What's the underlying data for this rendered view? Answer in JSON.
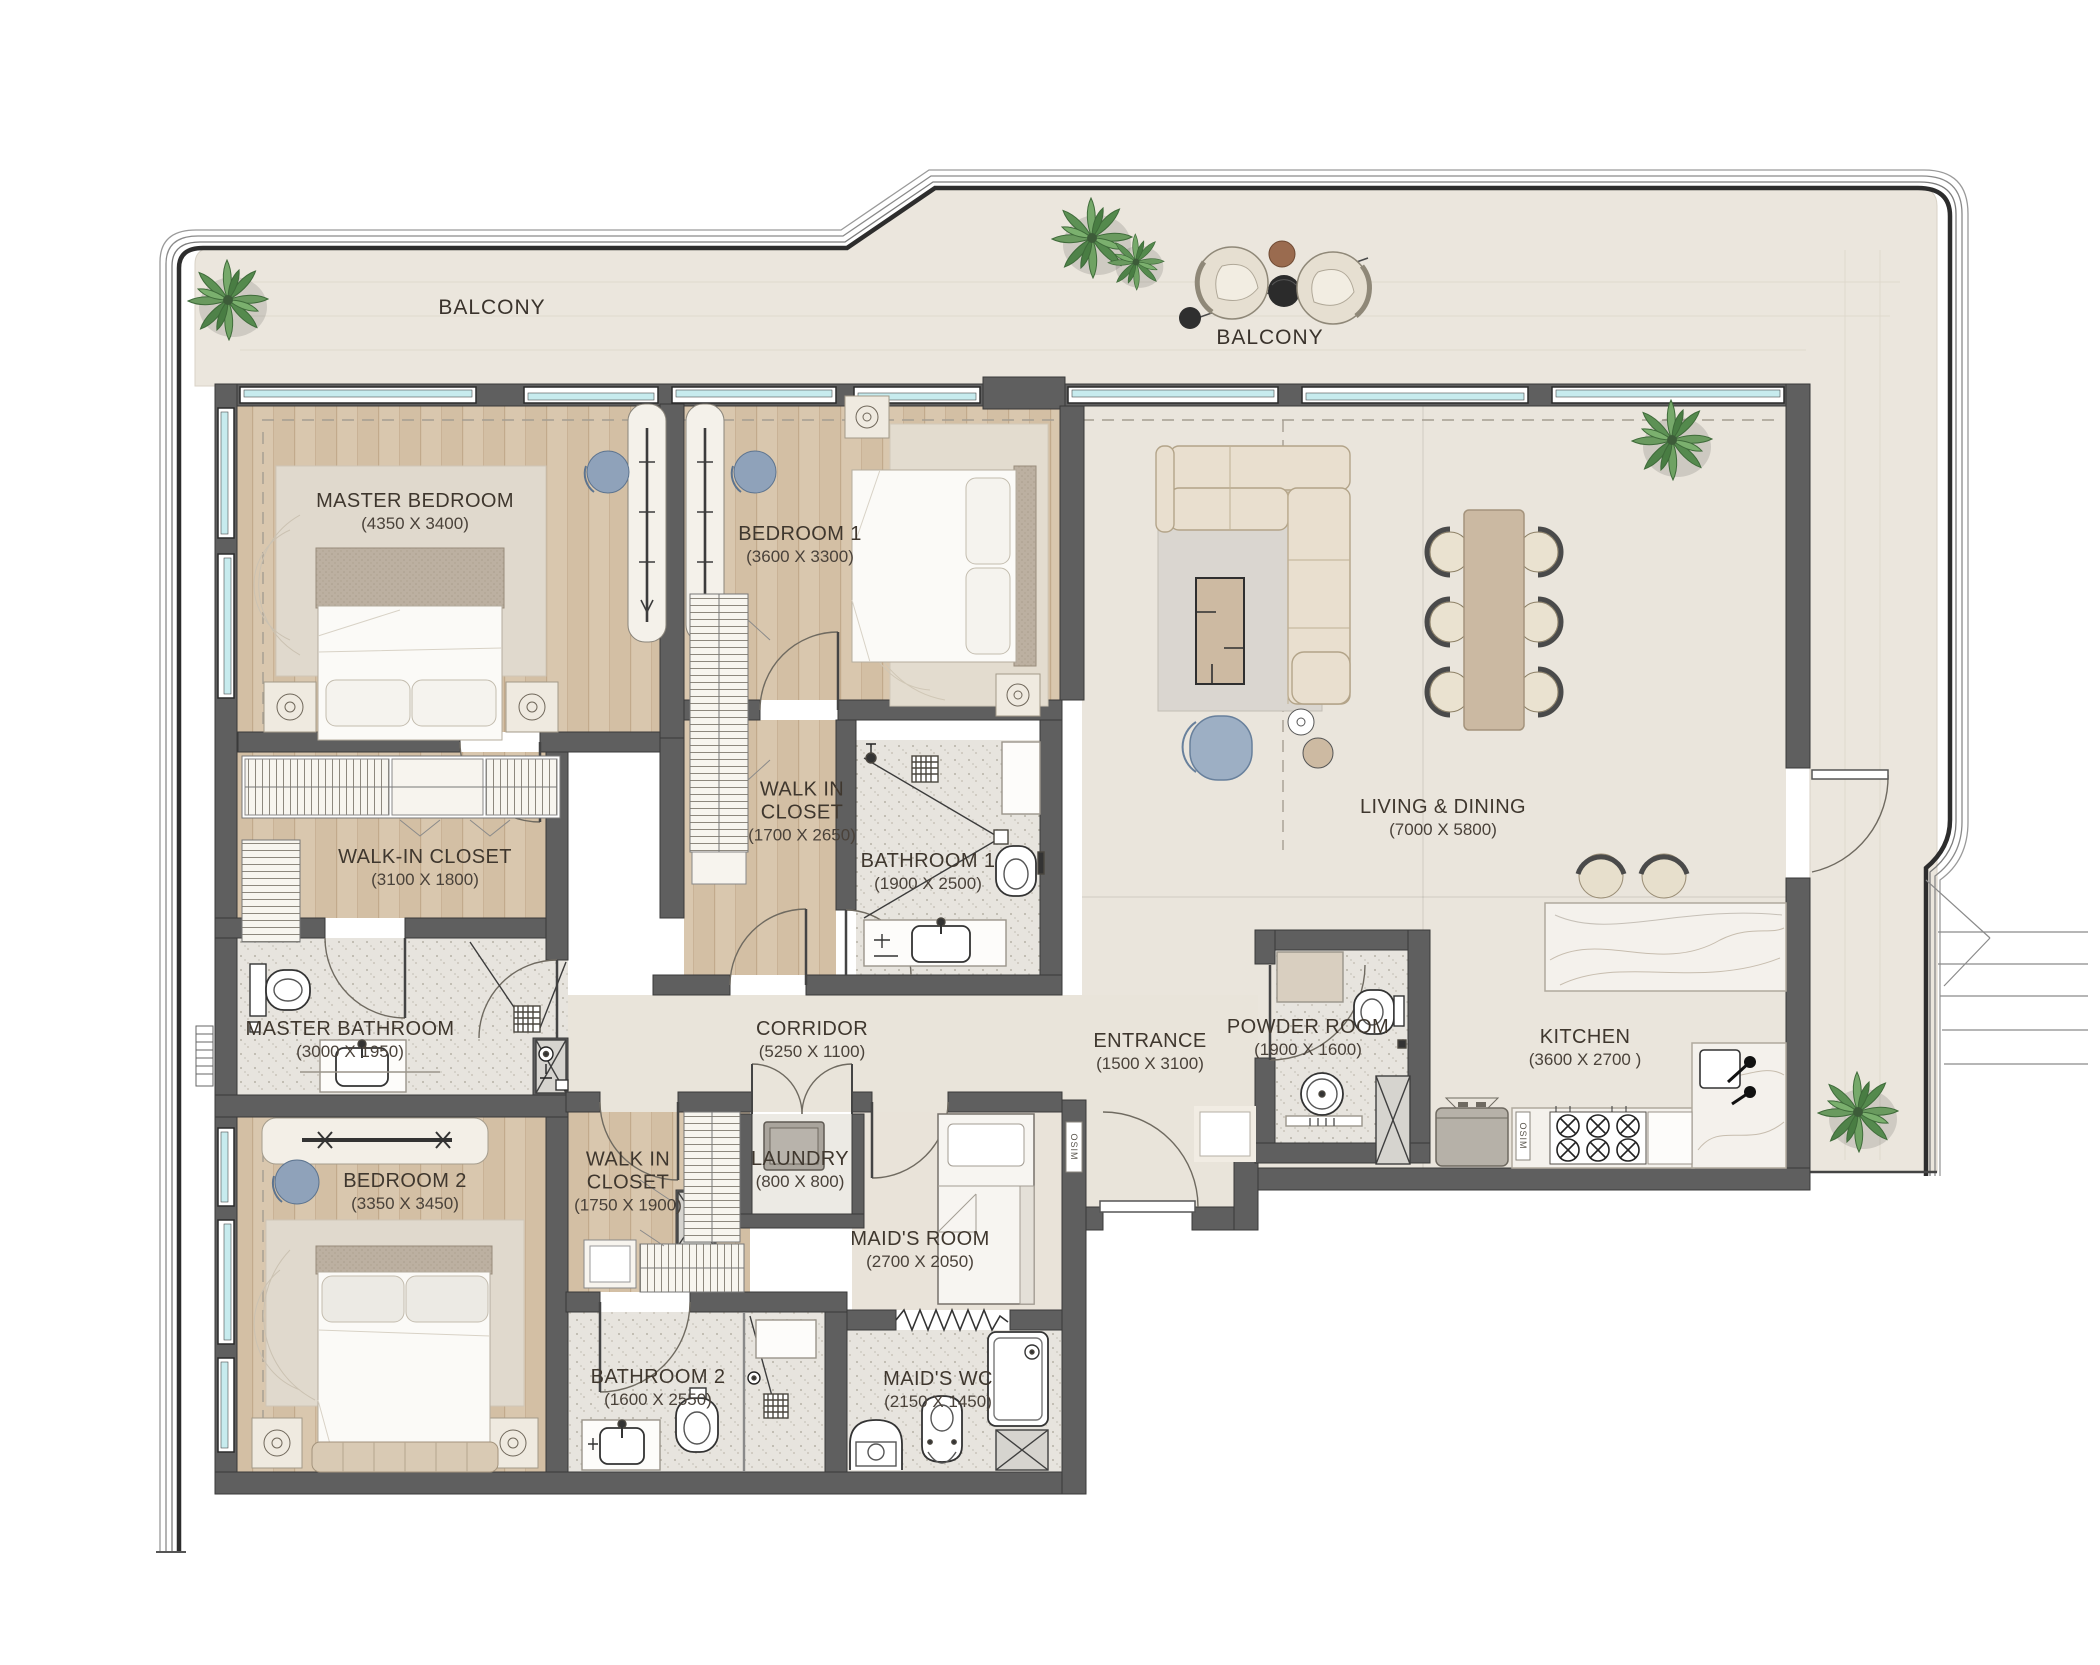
{
  "plan": {
    "balcony_labels": [
      "BALCONY",
      "BALCONY"
    ],
    "rooms": [
      {
        "name": "MASTER BEDROOM",
        "dims": "(4350 X 3400)"
      },
      {
        "name": "BEDROOM 1",
        "dims": "(3600 X 3300)"
      },
      {
        "name": "WALK-IN CLOSET",
        "dims": "(3100 X 1800)"
      },
      {
        "name": "WALK IN CLOSET",
        "dims": "(1700 X 2650)"
      },
      {
        "name": "BATHROOM 1",
        "dims": "(1900 X 2500)"
      },
      {
        "name": "MASTER BATHROOM",
        "dims": "(3000 X 1950)"
      },
      {
        "name": "BEDROOM 2",
        "dims": "(3350 X 3450)"
      },
      {
        "name": "WALK IN CLOSET",
        "dims": "(1750 X 1900)"
      },
      {
        "name": "LAUNDRY",
        "dims": "(800 X 800)"
      },
      {
        "name": "MAID'S ROOM",
        "dims": "(2700 X 2050)"
      },
      {
        "name": "BATHROOM 2",
        "dims": "(1600 X 2550)"
      },
      {
        "name": "MAID'S WC",
        "dims": "(2150 X 1450)"
      },
      {
        "name": "CORRIDOR",
        "dims": "(5250 X 1100)"
      },
      {
        "name": "ENTRANCE",
        "dims": "(1500 X 3100)"
      },
      {
        "name": "POWDER ROOM",
        "dims": "(1900 X 1600)"
      },
      {
        "name": "LIVING & DINING",
        "dims": "(7000 X 5800)"
      },
      {
        "name": "KITCHEN",
        "dims": "(3600 X 2700 )"
      }
    ],
    "door_tag": "OSIM",
    "palette": {
      "wall": "#5f5f5f",
      "glazing": "#c7ebee",
      "wood_floor": "#d9c7ae",
      "stone_floor": "#eae5dc",
      "balcony_floor": "#ebe6dd",
      "bath_floor": "#e7e4de",
      "sofa": "#e9dfcf",
      "accent_blue": "#9dafc4",
      "plant_green": "#6a9a5f",
      "marble": "#f4f1ec"
    }
  }
}
